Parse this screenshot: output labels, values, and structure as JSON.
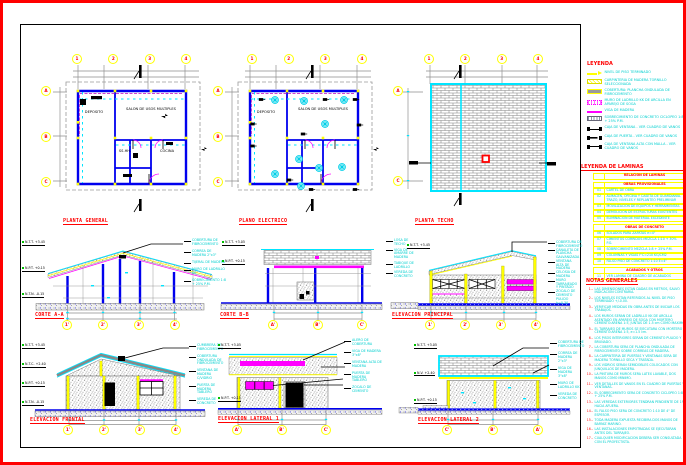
{
  "palette": {
    "border": "#ff0000",
    "walls": "#0000ee",
    "cyan": "#00ffff",
    "magenta": "#ff00ff",
    "yellow": "#ffff00",
    "gray": "#8f8f8f",
    "titles": "#ff0000"
  },
  "plans": [
    {
      "title": "PLANTA GENERAL",
      "bubbles_top": [
        "1",
        "2",
        "3",
        "4"
      ],
      "bubbles_left": [
        "A",
        "B",
        "C"
      ],
      "rooms": [
        "DEPOSITO",
        "SALON DE USOS MULTIPLES",
        "SS.HH.",
        "COCINA"
      ]
    },
    {
      "title": "PLANO ELECTRICO",
      "bubbles_top": [
        "1",
        "2",
        "3",
        "4"
      ],
      "bubbles_left": [
        "A",
        "B",
        "C"
      ],
      "rooms": [
        "DEPOSITO",
        "SALON DE USOS MULTIPLES"
      ]
    },
    {
      "title": "PLANTA TECHO",
      "bubbles_top": [
        "1",
        "2",
        "3",
        "4"
      ],
      "bubbles_left": [
        "A",
        "C"
      ]
    }
  ],
  "sections": [
    {
      "title": "CORTE A-A",
      "bubbles": [
        "1'",
        "2'",
        "3'",
        "4'"
      ],
      "callouts_left": [
        "N.T.T. +3.45",
        "N.P.T. +0.15",
        "N.T.N. -0.15"
      ],
      "callouts_right": [
        "COBERTURA DE FIBROCEMENTO",
        "CORREA DE MADERA 2\"x3\"",
        "TIJERAL DE MADERA",
        "MURO DE LADRILLO KK",
        "SOBRECIMIENTO 1:8 + 25% P.M."
      ]
    },
    {
      "title": "CORTE B-B",
      "bubbles": [
        "A'",
        "B'",
        "C'"
      ],
      "callouts_left": [
        "N.T.T. +3.05",
        "N.P.T. +0.15"
      ],
      "callouts_right": [
        "LOSA DE TECHO",
        "VIGA DE AMARRE DE MADERA",
        "TABIQUE DE LADRILLO",
        "VEREDA DE CONCRETO"
      ]
    },
    {
      "title": "ELEVACION PRINCIPAL",
      "bubbles": [
        "1'",
        "2'",
        "3'",
        "4'"
      ],
      "callouts_left": [
        "N.T.T. +3.45"
      ],
      "callouts_right": [
        "COBERTURA DE FIBROCEMENTO",
        "CANALETA DE PLANCHA GALVANIZADA",
        "VENTANA ALTA DE MADERA",
        "CELOSIA DE MADERA",
        "MURO TARRAJEADO Y PINTADO",
        "ZOCALO DE CEMENTO PULIDO h=0.30"
      ]
    }
  ],
  "elevations": [
    {
      "title": "ELEVACION FRONTAL",
      "bubbles": [
        "1'",
        "2'",
        "3'",
        "4'"
      ],
      "callouts_left": [
        "N.T.T. +3.45",
        "N.T.C. +2.40",
        "N.P.T. +0.15",
        "N.T.N. -0.15"
      ],
      "callouts_right": [
        "CUMBRERA DE FIBROCEMENTO",
        "COBERTURA ONDULADA DE FIBROCEMENTO",
        "VENTANA DE MADERA C/VIDRIO",
        "PUERTA DE MADERA TABLERO",
        "VEREDA DE CONCRETO"
      ]
    },
    {
      "title": "ELEVACION LATERAL 1",
      "bubbles": [
        "A'",
        "B'",
        "C'"
      ],
      "callouts_left": [
        "N.T.T. +3.05",
        "N.P.T. +0.15"
      ],
      "callouts_right": [
        "ALERO DE COBERTURA",
        "VIGA DE MADERA 3\"x8\"",
        "VENTANA ALTA DE MADERA",
        "PUERTA DE MADERA TABLERO",
        "ZOCALO DE CEMENTO"
      ]
    },
    {
      "title": "ELEVACION LATERAL 2",
      "bubbles": [
        "C'",
        "B'",
        "A'"
      ],
      "callouts_left": [
        "N.T.T. +3.05",
        "N.V. +2.40",
        "N.P.T. +0.15"
      ],
      "callouts_right": [
        "COBERTURA DE FIBROCEMENTO",
        "CORREA DE MADERA 2\"x3\"",
        "VIGA DE MADERA 3\"x8\"",
        "MURO DE LADRILLO KK",
        "VEREDA DE CONCRETO"
      ]
    }
  ],
  "legend": {
    "title": "LEYENDA",
    "items": [
      {
        "sw": "sw-npt",
        "label": "NIVEL DE PISO TERMINADO"
      },
      {
        "sw": "sw-wood",
        "label": "CARPINTERIA DE MADERA TORNILLO SELECCIONADA"
      },
      {
        "sw": "sw-fc",
        "label": "COBERTURA: PLANCHA ONDULADA DE FIBROCEMENTO"
      },
      {
        "sw": "sw-brickm",
        "label": "MURO DE LADRILLO KK DE ARCILLA EN APAREJO DE SOGA"
      },
      {
        "sw": "sw-beam",
        "label": "VIGA DE MADERA"
      },
      {
        "sw": "sw-cyclo",
        "label": "SOBRECIMIENTO DE CONCRETO CICLOPEO 1:8 + 25% P.M."
      },
      {
        "sw": "sw-win",
        "label": "CAJA DE VENTANA - VER CUADRO DE VANOS"
      },
      {
        "sw": "sw-door",
        "label": "CAJA DE PUERTA - VER CUADRO DE VANOS"
      },
      {
        "sw": "sw-winh",
        "label": "CAJA DE VENTANA ALTA CON MALLA - VER CUADRO DE VANOS"
      }
    ]
  },
  "sheet_index": {
    "title": "LEYENDA DE LAMINAS",
    "rows": [
      {
        "type": "h1",
        "code": "",
        "text": "RELACION DE LAMINAS"
      },
      {
        "type": "h2",
        "code": "",
        "text": "OBRAS PROVISIONALES"
      },
      {
        "type": "r",
        "code": "01",
        "text": "CARTEL DE OBRA"
      },
      {
        "type": "r",
        "code": "02",
        "text": "ALMACEN, OFICINA Y CASETA DE GUARDIANIA. TRAZO, NIVELES Y REPLANTEO PRELIMINAR"
      },
      {
        "type": "r",
        "code": "03",
        "text": "MOVILIZACION DE EQUIPOS Y HERRAMIENTAS"
      },
      {
        "type": "r",
        "code": "04",
        "text": "DEMOLICION DE ESTRUCTURAS EXISTENTES"
      },
      {
        "type": "r",
        "code": "05",
        "text": "ELIMINACION DE MATERIAL EXCEDENTE"
      },
      {
        "type": "h2",
        "code": "",
        "text": "OBRAS DE CONCRETO"
      },
      {
        "type": "r",
        "code": "06",
        "text": "SOLADOS PARA ZAPATAS e=4\""
      },
      {
        "type": "r",
        "code": "07",
        "text": "CIMIENTOS CORRIDOS MEZCLA 1:10 + 30% P.G."
      },
      {
        "type": "r",
        "code": "08",
        "text": "SOBRECIMIENTO MEZCLA 1:8 + 25% P.M."
      },
      {
        "type": "r",
        "code": "09",
        "text": "COLUMNAS Y VIGAS F'C=210 KG/CM2"
      },
      {
        "type": "r",
        "code": "10",
        "text": "FALSO PISO DE CONCRETO 1:10 E=4\""
      },
      {
        "type": "h2",
        "code": "",
        "text": "ACABADOS Y OTROS"
      },
      {
        "type": "r",
        "code": "11",
        "text": "VER LAMINA DE CUADRO DE ACABADOS"
      }
    ]
  },
  "notes": {
    "title": "NOTAS GENERALES",
    "items": [
      {
        "n": "1.-",
        "t": "LAS DIMENSIONES ESTAN DADAS EN METROS, SALVO INDICACION CONTRARIA."
      },
      {
        "n": "2.-",
        "t": "LOS NIVELES ESTAN REFERIDOS AL NIVEL DE PISO TERMINADO +/-0.00."
      },
      {
        "n": "3.-",
        "t": "VERIFICAR MEDIDAS EN OBRA ANTES DE INICIAR LOS TRABAJOS."
      },
      {
        "n": "4.-",
        "t": "LOS MUROS SERAN DE LADRILLO KK DE ARCILLA ASENTADO EN APAREJO DE SOGA CON MORTERO CEMENTO:ARENA 1:5, JUNTAS DE 1.5 cm COMO MAXIMO."
      },
      {
        "n": "5.-",
        "t": "EL TARRAJEO DE MUROS SE EJECUTARA CON MORTERO CEMENTO:ARENA 1:5, e=1.5 cm."
      },
      {
        "n": "6.-",
        "t": "LOS PISOS INTERIORES SERAN DE CEMENTO PULIDO Y BRUÑADO."
      },
      {
        "n": "7.-",
        "t": "LA COBERTURA SERA DE PLANCHA ONDULADA DE FIBROCEMENTO SOBRE CORREAS DE MADERA."
      },
      {
        "n": "8.-",
        "t": "LA CARPINTERIA DE PUERTAS Y VENTANAS SERA DE MADERA TORNILLO SECA Y TRATADA."
      },
      {
        "n": "9.-",
        "t": "LOS VIDRIOS SERAN SEMIDOBLES COLOCADOS CON JUNQUILLOS DE MADERA."
      },
      {
        "n": "10.-",
        "t": "LA PINTURA DE MUROS SERA LATEX LAVABLE, DOS MANOS COMO MINIMO."
      },
      {
        "n": "11.-",
        "t": "VER DETALLES DE VANOS EN EL CUADRO DE PUERTAS Y VENTANAS."
      },
      {
        "n": "12.-",
        "t": "EL SOBRECIMIENTO SERA DE CONCRETO CICLOPEO 1:8 + 25% P.M."
      },
      {
        "n": "13.-",
        "t": "LAS VEREDAS EXTERIORES TENDRAN PENDIENTE DE 1% HACIA AFUERA."
      },
      {
        "n": "14.-",
        "t": "EL FALSO PISO SERA DE CONCRETO 1:10 DE 4\" DE ESPESOR."
      },
      {
        "n": "15.-",
        "t": "TODA MADERA EXPUESTA RECIBIRA DOS MANOS DE BARNIZ MARINO."
      },
      {
        "n": "16.-",
        "t": "LAS INSTALACIONES EMPOTRADAS SE EJECUTARAN ANTES DEL TARRAJEO."
      },
      {
        "n": "17.-",
        "t": "CUALQUIER MODIFICACION DEBERA SER CONSULTADA CON EL PROYECTISTA."
      }
    ]
  }
}
